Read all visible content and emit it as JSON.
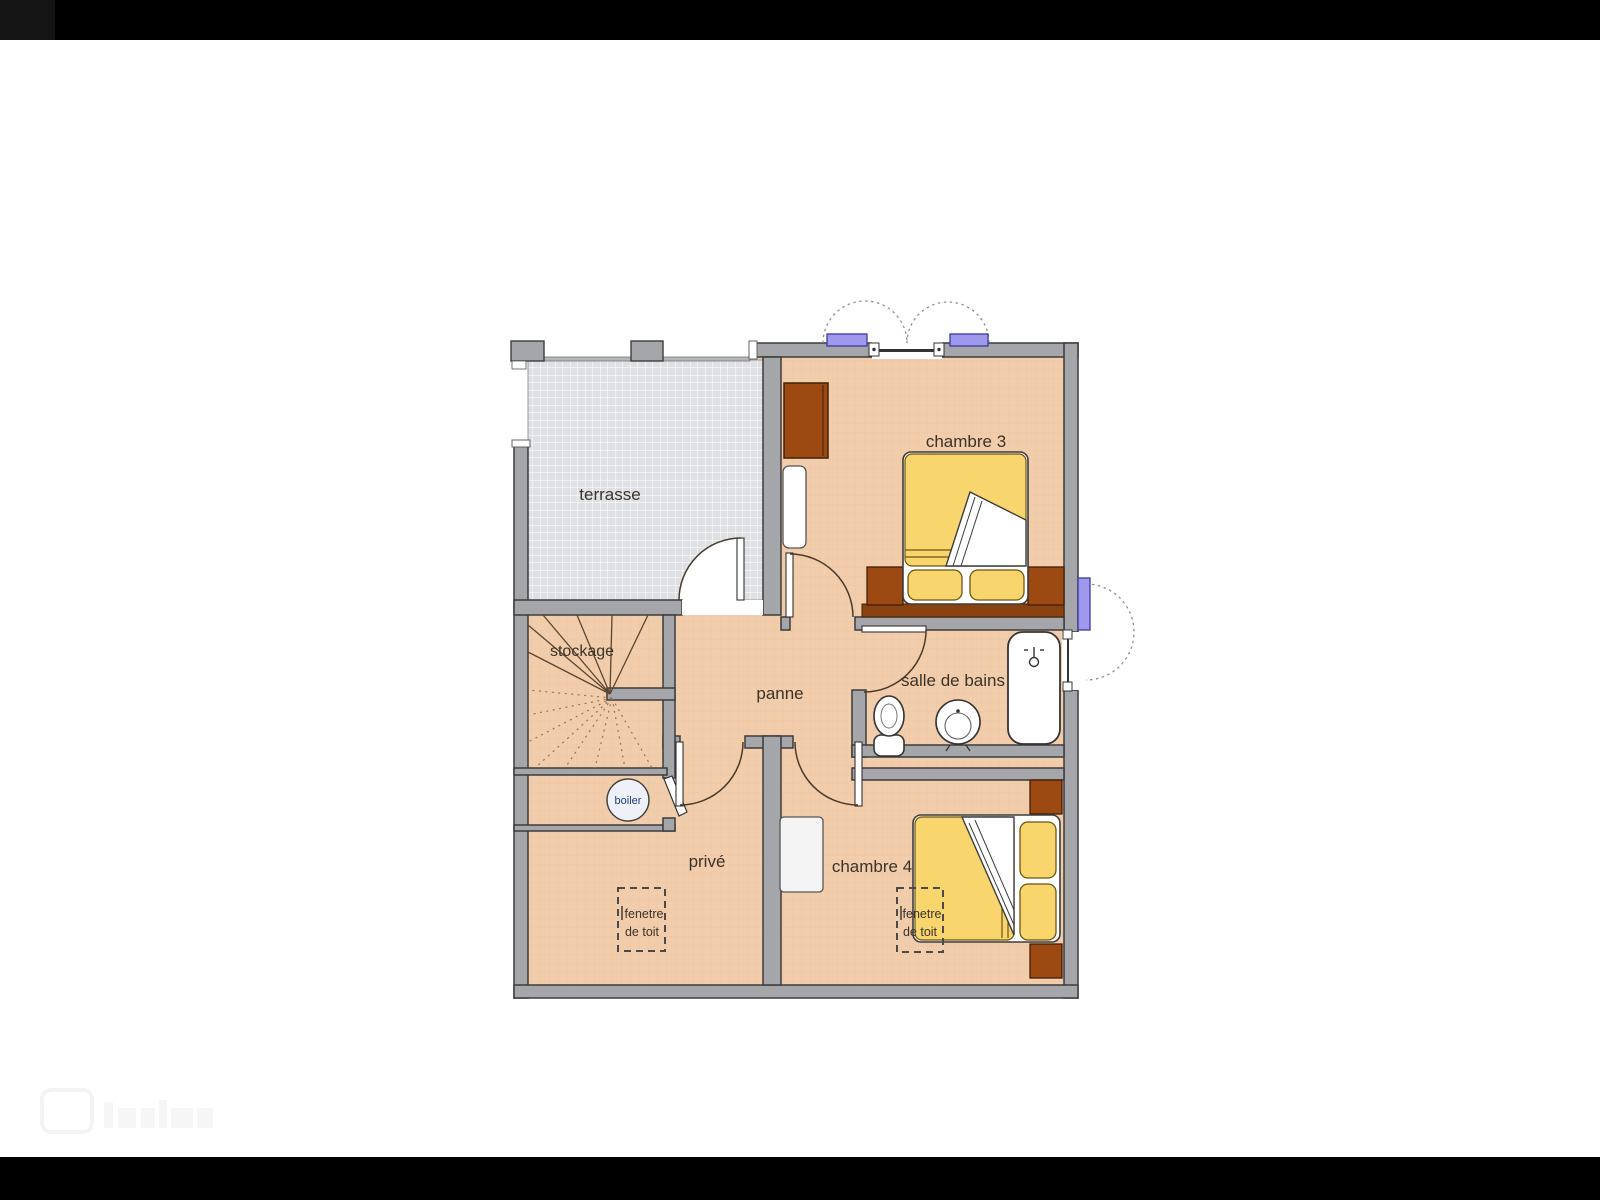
{
  "plan": {
    "type": "architectural floor plan (upper storey)",
    "language": "French"
  },
  "labels": {
    "terrasse": "terrasse",
    "stockage": "stockage",
    "panne": "panne",
    "salle_de_bains": "salle de bains",
    "chambre3": "chambre 3",
    "chambre4": "chambre 4",
    "prive": "privé",
    "boiler": "boiler"
  },
  "roof_window": {
    "line1": "fenetre",
    "line2": "de toit"
  },
  "colors": {
    "letterbox": "#000000",
    "wall_fill": "#a4a6a9",
    "wall_outline": "#3c3c3c",
    "floor": "#f2cdab",
    "floor_grid": "#e6bb97",
    "tile": "#dfe0e3",
    "tile_line": "#ffffff",
    "wood": "#9c4a12",
    "wood_dark": "#8a4210",
    "bed_yellow": "#f8d56d",
    "window_purple": "#9e99ec",
    "door_arc": "#4a3b2d",
    "swing_dotted": "#8f8f8f",
    "boiler_text": "#1d3f7a",
    "label_text": "#3a332a"
  }
}
